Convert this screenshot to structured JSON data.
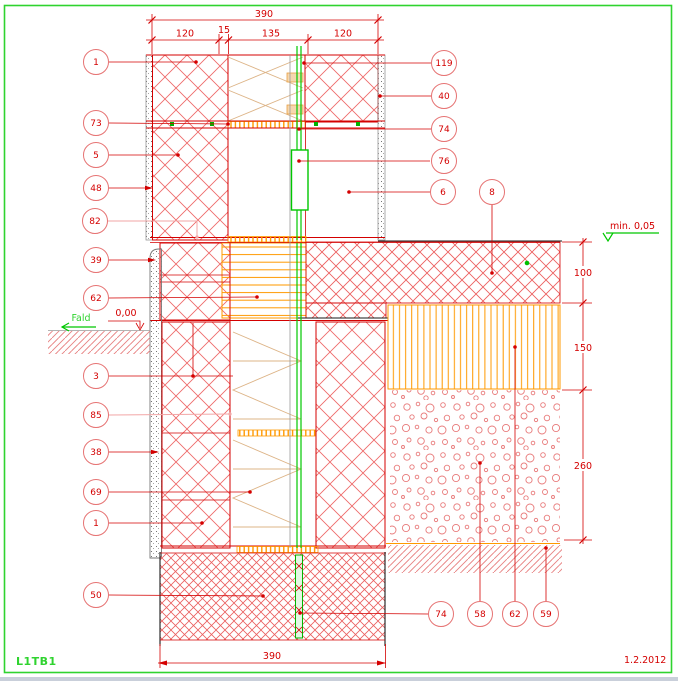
{
  "drawing": {
    "sheet_code": "L1TB1",
    "date": "1.2.2012",
    "annotations": {
      "min_level": "min. 0,05",
      "slope_label": "Fald",
      "zero_level": "0,00"
    },
    "dimensions": {
      "top_total": "390",
      "top_segments": [
        "120",
        "15",
        "135",
        "120"
      ],
      "right_segments": [
        "100",
        "150",
        "260"
      ],
      "bottom_total": "390"
    },
    "callouts": {
      "left": [
        "1",
        "73",
        "5",
        "48",
        "82",
        "39",
        "62",
        "3",
        "85",
        "38",
        "69",
        "1",
        "50"
      ],
      "right": [
        "119",
        "40",
        "74",
        "76",
        "6",
        "8"
      ],
      "bottom": [
        "74",
        "58",
        "62",
        "59"
      ]
    },
    "colors": {
      "line_red": "#d40000",
      "hatch_red": "#ee6a6a",
      "orange": "#ff9900",
      "tie_tan": "#ddb487",
      "green": "#00c800",
      "frame_green": "#2fd32f",
      "grey": "#9a9a9a",
      "black": "#1a1a1a"
    }
  }
}
